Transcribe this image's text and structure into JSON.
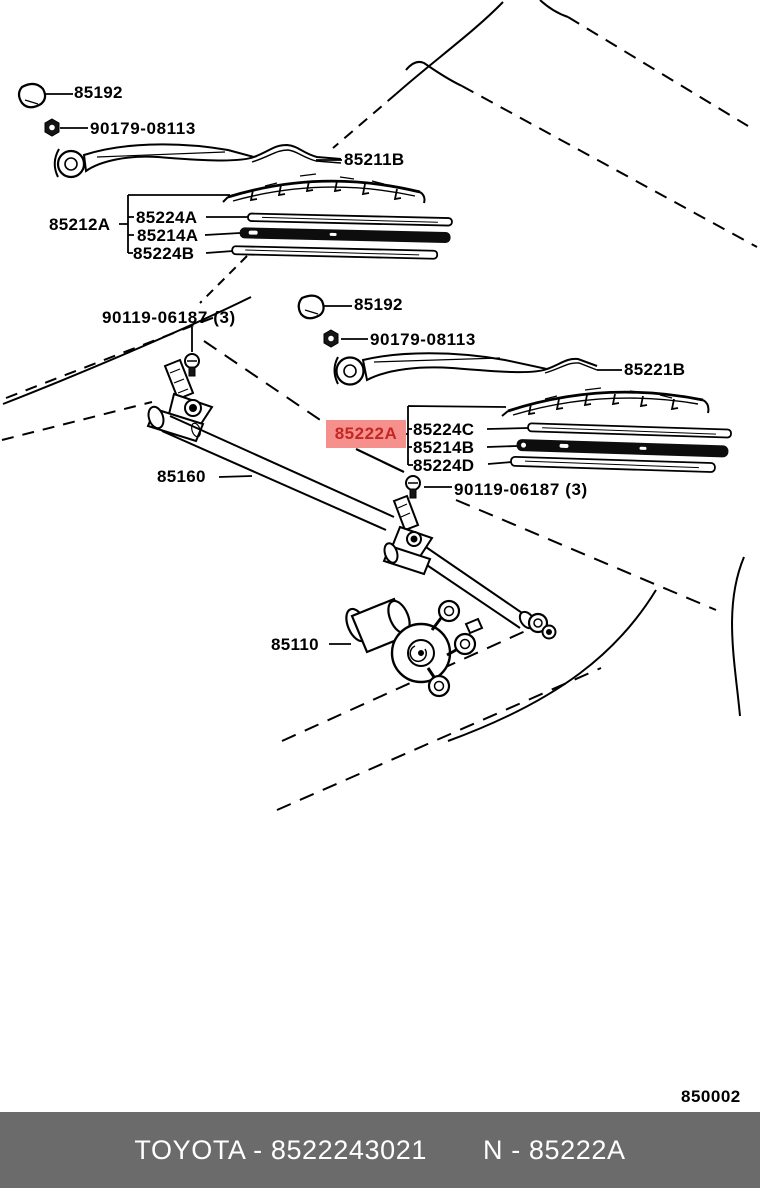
{
  "figure_number": "850002",
  "colors": {
    "line": "#000000",
    "highlight_bg": "#F5908D",
    "highlight_text": "#C42722",
    "footer_bg": "#6B6B6B",
    "footer_text": "#FFFFFF"
  },
  "parts": {
    "cap_top": "85192",
    "nut_top": "90179-08113",
    "arm_top": "85211B",
    "blade_group_top": "85212A",
    "blade_top": [
      "85224A",
      "85214A",
      "85224B"
    ],
    "pivot_bolt_left": "90119-06187 (3)",
    "cap_mid": "85192",
    "nut_mid": "90179-08113",
    "arm_mid": "85221B",
    "highlighted_part": "85222A",
    "blade_mid": [
      "85224C",
      "85214B",
      "85224D"
    ],
    "linkage": "85160",
    "pivot_bolt_mid": "90119-06187 (3)",
    "motor": "85110"
  },
  "footer": {
    "left_code": "TOYOTA - 8522243021",
    "right_code": "N - 85222A"
  }
}
